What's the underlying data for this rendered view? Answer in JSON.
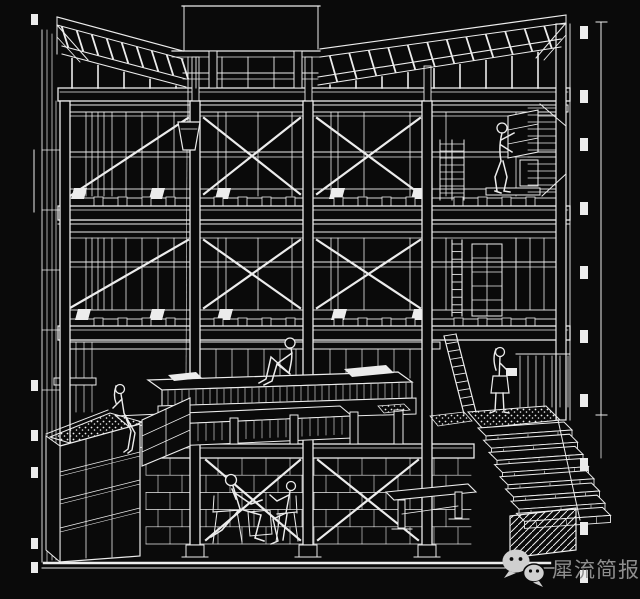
{
  "colors": {
    "bg": "#0a0a0a",
    "line": "#ececec",
    "wm-text": "#8e8e8e",
    "wm-icon": "#cfcfcf"
  },
  "drawing": {
    "description": "White-on-black sectional perspective line drawing of a four-level braced frame house: butterfly roof with hoist and hanging bucket, two window floors with X cross-bracing, ladders and shelving on the right, a mezzanine platform, a planted deck on the left, a stair flight to the lower right, a block-walled basement, and six human figures",
    "style": "white ink on black"
  },
  "watermark": {
    "text": "犀流简报",
    "icon": "wechat-logo"
  }
}
